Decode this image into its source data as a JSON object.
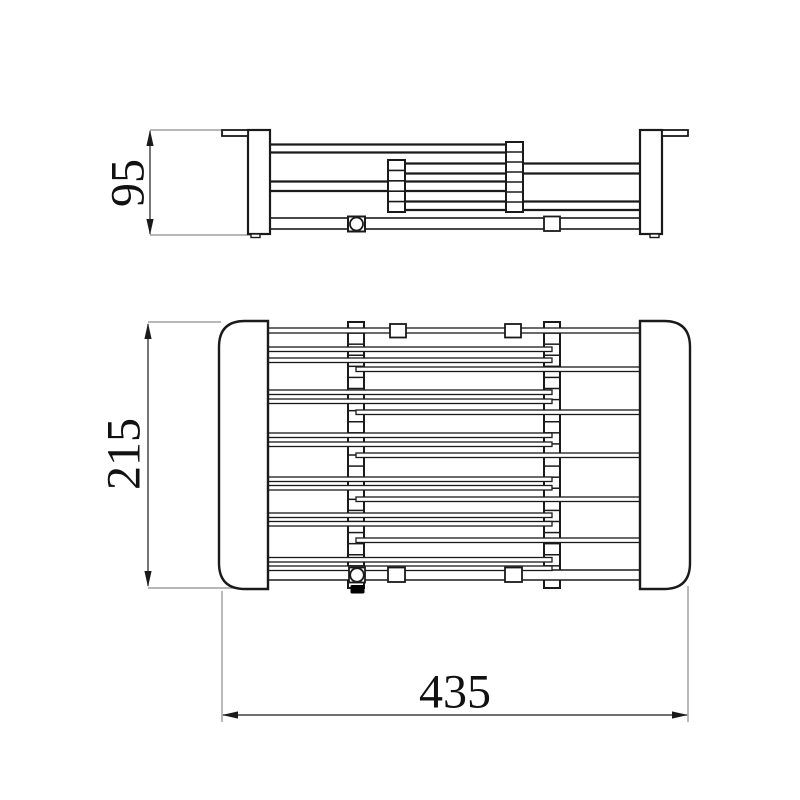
{
  "page": {
    "background": "#ffffff",
    "kind": "technical drawing, orthographic projection of expandable dish rack"
  },
  "drawing": {
    "views": {
      "side": {
        "name": "side-elevation-view"
      },
      "plan": {
        "name": "top-plan-view"
      }
    },
    "dimensions": {
      "height": {
        "label": "95",
        "value": 95,
        "unit": "mm",
        "orientation": "vertical",
        "applies_to": "side view height"
      },
      "depth": {
        "label": "215",
        "value": 215,
        "unit": "mm",
        "orientation": "vertical",
        "applies_to": "plan view depth"
      },
      "width": {
        "label": "435",
        "value": 435,
        "unit": "mm",
        "orientation": "horizontal",
        "applies_to": "overall width"
      }
    },
    "colors": {
      "line": "#1a1a1a",
      "extension_line": "#8c8c8c",
      "text": "#111111",
      "background": "#ffffff",
      "knob_fill": "#000000"
    },
    "icons": {
      "knob": "locking-knob-icon",
      "arrows": "dimension-arrowheads"
    }
  }
}
